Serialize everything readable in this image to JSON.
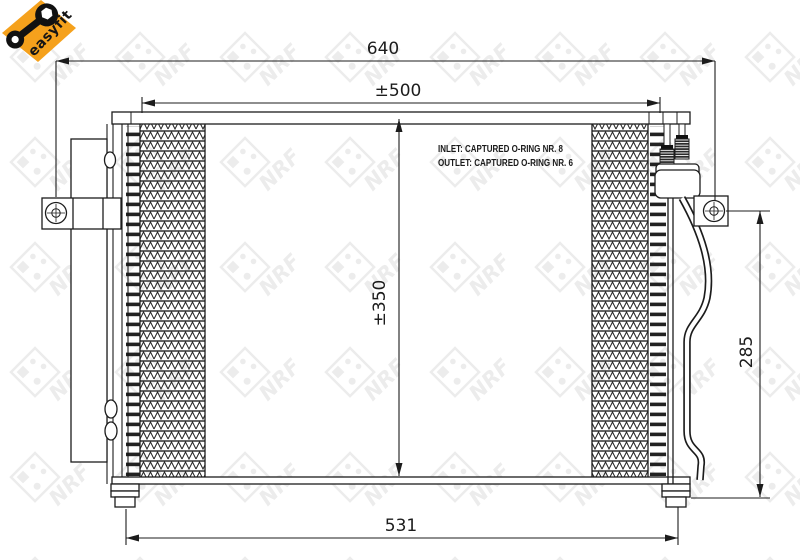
{
  "badge": {
    "label": "easyfit",
    "color": "#f5a11c"
  },
  "watermark": {
    "text": "NRF"
  },
  "notes": {
    "inlet": "INLET: CAPTURED O-RING NR. 8",
    "outlet": "OUTLET: CAPTURED O-RING NR. 6"
  },
  "dimensions": {
    "total_width": {
      "label": "640"
    },
    "core_width": {
      "label": "±500"
    },
    "core_height": {
      "label": "±350"
    },
    "bracket_height": {
      "label": "285"
    },
    "mount_width": {
      "label": "531"
    }
  },
  "colors": {
    "line": "#1c1c1c",
    "badge_orange": "#f5a11c",
    "watermark_gray": "#ececec"
  }
}
